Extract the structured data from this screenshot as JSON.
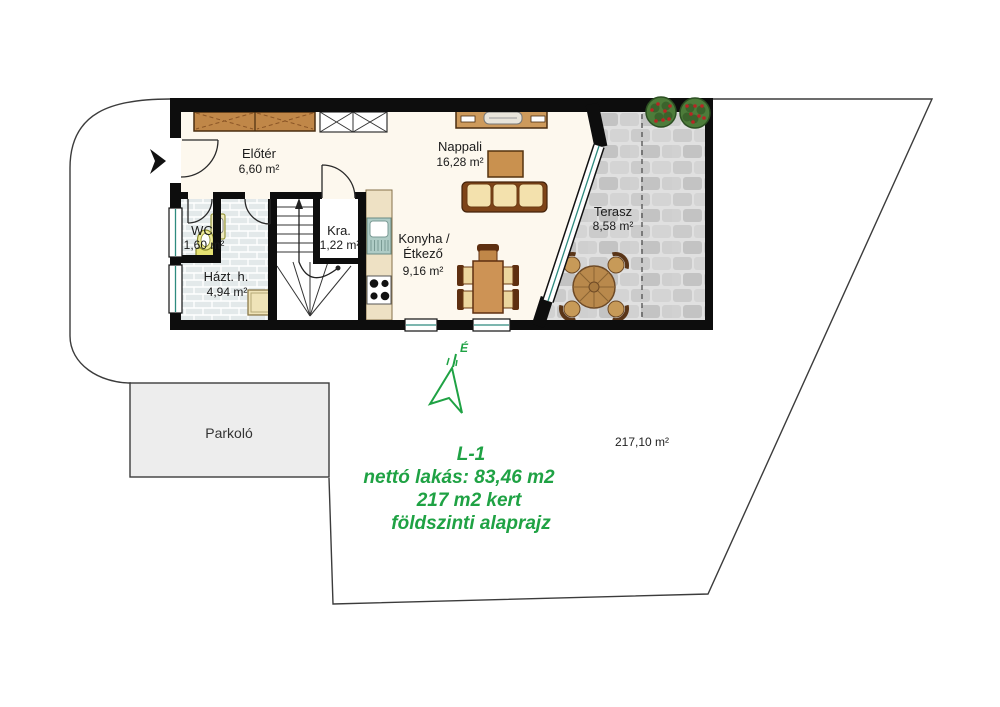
{
  "plan": {
    "rooms": [
      {
        "name": "Előtér",
        "area": "6,60 m²"
      },
      {
        "name": "WC",
        "area": "1,60 m²"
      },
      {
        "name": "Házt. h.",
        "area": "4,94 m²"
      },
      {
        "name": "Kra.",
        "area": "1,22 m²"
      },
      {
        "name1": "Konyha /",
        "name2": "Étkező",
        "area": "9,16 m²"
      },
      {
        "name": "Nappali",
        "area": "16,28 m²"
      },
      {
        "name": "Terasz",
        "area": "8,58 m²"
      }
    ],
    "parking_label": "Parkoló",
    "plot_area_label": "217,10 m²",
    "north_label": "É"
  },
  "annotations": {
    "unit_id": "L-1",
    "net_area_line": "nettó lakás: 83,46 m2",
    "garden_line": "217 m2 kert",
    "floor_line": "földszinti alaprajz",
    "accent_color": "#1fa244"
  },
  "colors": {
    "wall": "#0d0d0d",
    "floor": "#fdf8ee",
    "furniture_wood": "#cd9a5c",
    "window_glass": "#2e8b7f",
    "terrace_stone": "#d8d8d8",
    "plant_green": "#4d7c3a",
    "annotation_green": "#1fa244"
  }
}
